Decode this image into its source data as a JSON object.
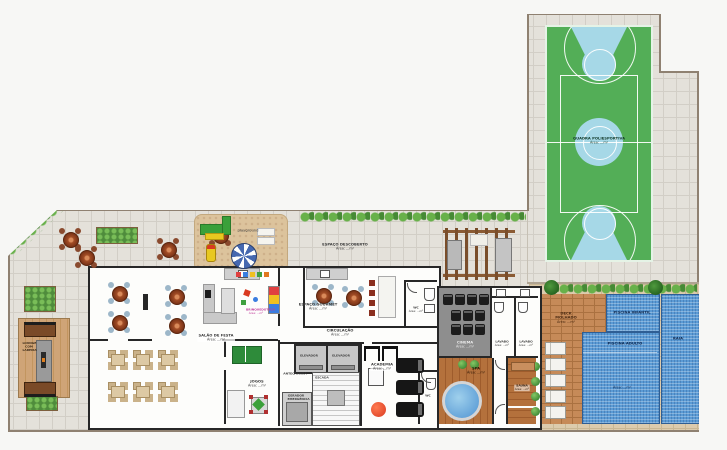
{
  "colors": {
    "court_green": "#53ae57",
    "court_key_blue": "#a6d8e7",
    "pool_blue": "#5b9bd5",
    "deck_wood": "#b4713c",
    "deck_brick": "#c68a58",
    "paver_gray": "#e4e1da",
    "paver_tan": "#dccbad",
    "sand": "#dcc39c",
    "hedge_green": "#68b14a"
  },
  "areas": {
    "quadra": {
      "label": "QUADRA POLIESPORTIVA",
      "area": "Área: ...m²"
    },
    "espaco_descoberto": {
      "label": "ESPAÇO DESCOBERTO",
      "area": "Área: ...m²"
    },
    "playground": {
      "label": "playground"
    },
    "lounge": {
      "label": "LOUNGE COM LAREIRA"
    },
    "salao_festa": {
      "label": "SALÃO DE FESTA",
      "area": "Área: ...m²"
    },
    "brinquedoteca": {
      "label": "BRINQUEDOTECA",
      "area": "Área: ...m²"
    },
    "jogos": {
      "label": "JOGOS",
      "area": "Área: ...m²"
    },
    "espaco_gourmet": {
      "label": "ESPAÇO GOURMET",
      "area": "Área: ...m²"
    },
    "circulacao": {
      "label": "CIRCULAÇÃO",
      "area": "Área: ...m²"
    },
    "elevador": {
      "label": "ELEVADOR"
    },
    "antecamara": {
      "label": "ANTECÂMARA"
    },
    "escada": {
      "label": "ESCADA"
    },
    "gerador": {
      "label": "GERADOR EMERGÊNCIA"
    },
    "academia": {
      "label": "ACADEMIA",
      "area": "Área: ...m²"
    },
    "wc": {
      "label": "WC",
      "area": "Área: ...m²"
    },
    "cinema": {
      "label": "CINEMA",
      "area": "Área: ...m²"
    },
    "lavabo": {
      "label": "LAVABO",
      "area": "Área: ...m²"
    },
    "spa": {
      "label": "SPA",
      "area": "Área: ...m²"
    },
    "sauna": {
      "label": "SAUNA",
      "area": "Área: ...m²"
    },
    "deck_molhado": {
      "label": "DECK MOLHADO",
      "area": "Área: ...m²"
    },
    "piscina_infantil": {
      "label": "PISCINA INFANTIL"
    },
    "piscina_adulto": {
      "label": "PISCINA ADULTO",
      "area": "Área: ...m²"
    },
    "raia": {
      "label": "RAIA"
    }
  }
}
